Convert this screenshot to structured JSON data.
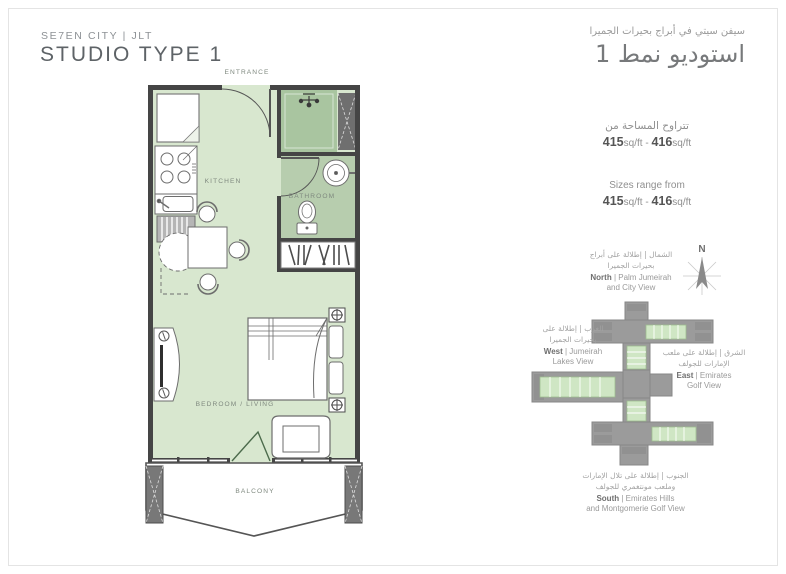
{
  "header": {
    "project": "SE7EN CITY | JLT",
    "title": "STUDIO TYPE 1",
    "project_ar": "سيفن سيتي في أبراج بحيرات الجميرا",
    "title_ar": "استوديو نمط 1"
  },
  "sizes": {
    "ar_label": "تتراوح المساحة من",
    "en_label": "Sizes range from",
    "min": "415",
    "max": "416",
    "unit": "sq/ft",
    "sep": " - "
  },
  "plan_labels": {
    "entrance": "ENTRANCE",
    "kitchen": "KITCHEN",
    "bathroom": "BATHROOM",
    "bedroom": "BEDROOM / LIVING",
    "balcony": "BALCONY"
  },
  "compass": {
    "north": "N"
  },
  "views": {
    "north": {
      "ar1": "الشمال | إطلالة على أبراج",
      "ar2": "بحيرات الجميرا",
      "dir": "North",
      "rest1": " | Palm Jumeirah",
      "line2": "and City View"
    },
    "west": {
      "ar1": "الغرب | إطلالة على",
      "ar2": "بحيرات الجميرا",
      "dir": "West",
      "rest1": " | Jumeirah",
      "line2": "Lakes View"
    },
    "east": {
      "ar1": "الشرق | إطلالة على ملعب",
      "ar2": "الإمارات للجولف",
      "dir": "East",
      "rest1": " | Emirates",
      "line2": "Golf View"
    },
    "south": {
      "ar1": "الجنوب | إطلالة على تلال الإمارات",
      "ar2": "وملعب مونتغمري للجولف",
      "dir": "South",
      "rest1": " | Emirates Hills",
      "line2": "and Montgomerie Golf View"
    }
  },
  "colors": {
    "floor_green": "#d8e7cf",
    "wet_green": "#b7cdae",
    "shower_green": "#a9c5a0",
    "wall_dark": "#454545",
    "building_gray": "#9b9b9b",
    "unit_green": "#cfe6c4"
  }
}
